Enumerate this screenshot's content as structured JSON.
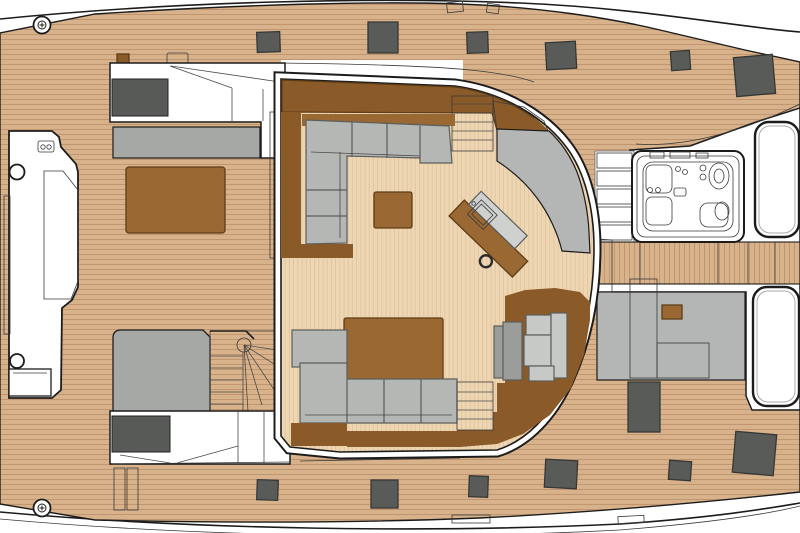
{
  "diagram": {
    "type": "deck-plan",
    "subject": "catamaran-yacht",
    "view": "top-down",
    "areas": [
      "side-deck-port",
      "side-deck-starboard",
      "bow-console",
      "sun-pad",
      "saloon",
      "galley-island",
      "sink",
      "spiral-staircase",
      "upper-staircase",
      "aft-staircase",
      "jacuzzi",
      "jacuzzi-steps",
      "aft-platform",
      "helm-seat",
      "skylight-panels",
      "deck-hatches",
      "winches",
      "cleats",
      "windshield"
    ]
  },
  "colors": {
    "deck_base": "#d8b28a",
    "deck_stripe": "#bb916c",
    "floor_base": "#eed6b2",
    "floor_stripe": "#dcc09b",
    "stair": "#dcb58d",
    "wood_dark": "#8a5a29",
    "wood_mid": "#9a6832",
    "sofa_gray": "#b5b7b4",
    "seat_gray": "#c7c9c6",
    "platform_gray": "#b3b6b4",
    "walkway_gray": "#a6a8a6",
    "panel_gray": "#9b9d9b",
    "window_dark": "#585a58",
    "hatch_dark": "#595b59",
    "outline": "#1c1c1c",
    "white": "#ffffff"
  },
  "deck_hatches": [
    {
      "x": 257,
      "y": 32,
      "w": 23,
      "h": 20,
      "r": -2
    },
    {
      "x": 368,
      "y": 22,
      "w": 30,
      "h": 31,
      "r": 0
    },
    {
      "x": 467,
      "y": 32,
      "w": 21,
      "h": 21,
      "r": -2
    },
    {
      "x": 546,
      "y": 42,
      "w": 30,
      "h": 27,
      "r": -3
    },
    {
      "x": 671,
      "y": 51,
      "w": 19,
      "h": 19,
      "r": -4
    },
    {
      "x": 735,
      "y": 56,
      "w": 39,
      "h": 39,
      "r": -5
    },
    {
      "x": 257,
      "y": 480,
      "w": 21,
      "h": 20,
      "r": 2
    },
    {
      "x": 371,
      "y": 480,
      "w": 27,
      "h": 28,
      "r": 0
    },
    {
      "x": 469,
      "y": 476,
      "w": 19,
      "h": 21,
      "r": 2
    },
    {
      "x": 545,
      "y": 460,
      "w": 32,
      "h": 28,
      "r": 3
    },
    {
      "x": 669,
      "y": 461,
      "w": 22,
      "h": 19,
      "r": 4
    },
    {
      "x": 734,
      "y": 433,
      "w": 41,
      "h": 41,
      "r": 5
    },
    {
      "x": 628,
      "y": 382,
      "w": 32,
      "h": 50,
      "r": 0
    }
  ],
  "windows": [
    {
      "x": 112,
      "y": 79,
      "w": 56,
      "h": 37
    },
    {
      "x": 112,
      "y": 416,
      "w": 58,
      "h": 36
    }
  ],
  "winches": [
    {
      "x": 42,
      "y": 25
    },
    {
      "x": 42,
      "y": 508
    }
  ],
  "jacuzzi": {
    "x": 632,
    "y": 151,
    "w": 112,
    "h": 91,
    "seats": 2
  },
  "skylight_panels": [
    {
      "x": 755,
      "y": 122,
      "w": 44,
      "h": 115
    },
    {
      "x": 753,
      "y": 287,
      "w": 46,
      "h": 119
    }
  ]
}
